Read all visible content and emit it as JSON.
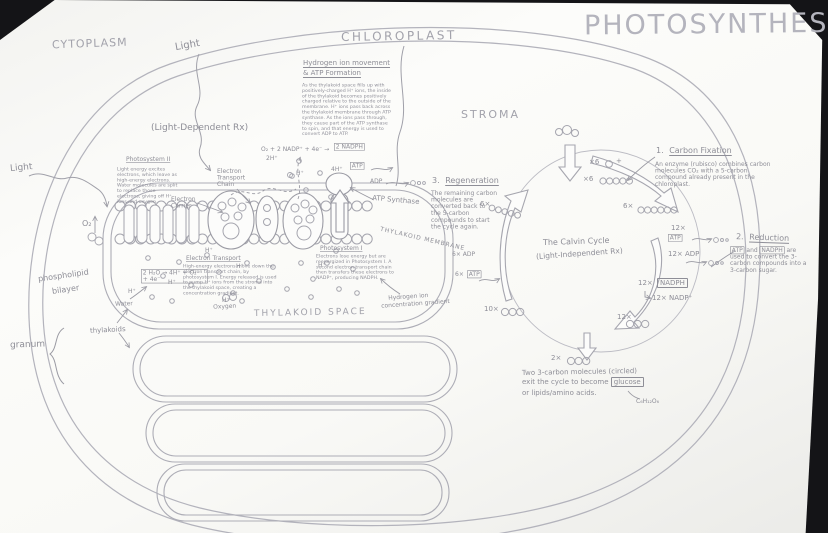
{
  "title": "PHOTOSYNTHESIS",
  "regions": {
    "cytoplasm": "CYTOPLASM",
    "chloroplast": "CHLOROPLAST",
    "stroma": "STROMA",
    "thylakoid_space": "THYLAKOID SPACE",
    "thylakoid_membrane": "THYLAKOID MEMBRANE",
    "granum": "granum",
    "thylakoids": "thylakoids",
    "phospholipid": "phospholipid",
    "bilayer": "bilayer",
    "water": "Water",
    "oxygen": "Oxygen",
    "o2": "O₂"
  },
  "light": {
    "top": "Light",
    "left": "Light",
    "dependent": "(Light-Dependent Rx)"
  },
  "ps2": {
    "title": "Photosystem II",
    "body": "Light energy excites electrons, which leave as high-energy electrons. Water molecules are split to replace those electrons, giving off H⁺ ions and oxygen."
  },
  "etc_label": "Electron Transport Chain",
  "carrier_label": "Electron Carrier",
  "etrans": {
    "title": "Electron Transport",
    "body": "High-energy electrons move down the electron transport chain, by photosystem I. Energy released is used to pump H⁺ ions from the stroma into the thylakoid space, creating a concentration gradient."
  },
  "ps1": {
    "title": "Photosystem I",
    "body": "Electrons lose energy but are reenergized in Photosystem I. A second electron transport chain then transfers these electrons to NADP⁺, producing NADPH."
  },
  "hydro": {
    "t1": "Hydrogen ion movement",
    "t2": "& ATP Formation",
    "body": "As the thylakoid space fills up with positively-charged H⁺ ions, the inside of the thylakoid becomes positively charged relative to the outside of the membrane. H⁺ ions pass back across the thylakoid membrane through ATP synthase. As the ions pass through, they cause part of the ATP synthase to spin, and that energy is used to convert ADP to ATP."
  },
  "eq": {
    "nadph_pre": "O₂ + 2 NADP⁺ + 4e⁻ →",
    "nadph_box": "2 NADPH",
    "h2": "2H⁺",
    "h4": "4H⁺",
    "hplus": "H⁺",
    "split1": "2 H₂O → 4H⁺ + O₂",
    "split2": "+ 4e⁻"
  },
  "syn": {
    "atp": "ATP",
    "adp": "ADP",
    "label": "ATP Synthase"
  },
  "gradient": {
    "l1": "Hydrogen ion",
    "l2": "concentration gradient"
  },
  "calvin": {
    "title": "The Calvin Cycle",
    "subtitle": "(Light-Independent Rx)",
    "fix": {
      "num": "1.",
      "title": "Carbon Fixation",
      "body": "An enzyme (rubisco) combines carbon molecules CO₂ with a 5-carbon compound already present in the chloroplast."
    },
    "red": {
      "num": "2.",
      "title": "Reduction",
      "atp": "ATP",
      "and": " and ",
      "nadph": "NADPH",
      "rest": " are used to convert the 3-carbon compounds into a 3-carbon sugar."
    },
    "regen": {
      "num": "3.",
      "title": "Regeneration",
      "body": "The remaining carbon molecules are converted back to the 5-carbon compounds to start the cycle again."
    },
    "counts": {
      "co2": "×6",
      "plus": "+",
      "rubp": "×6",
      "sixc": "6×",
      "threec": "12×",
      "exit": "2×",
      "recycle": "10×",
      "regen": "6×"
    },
    "co": {
      "atp12": "12×",
      "atp": "ATP",
      "adp12": "12× ADP",
      "nadph12": "12×",
      "nadph": "NADPH",
      "nadp12": "12× NADP⁺",
      "adp6": "6× ADP",
      "atp6": "6×"
    },
    "exit": {
      "l1": "Two 3-carbon molecules (circled)",
      "l2": "exit the cycle to become ",
      "glucose": "glucose",
      "l3": "or lipids/amino acids.",
      "formula": "C₆H₁₂O₆"
    }
  }
}
